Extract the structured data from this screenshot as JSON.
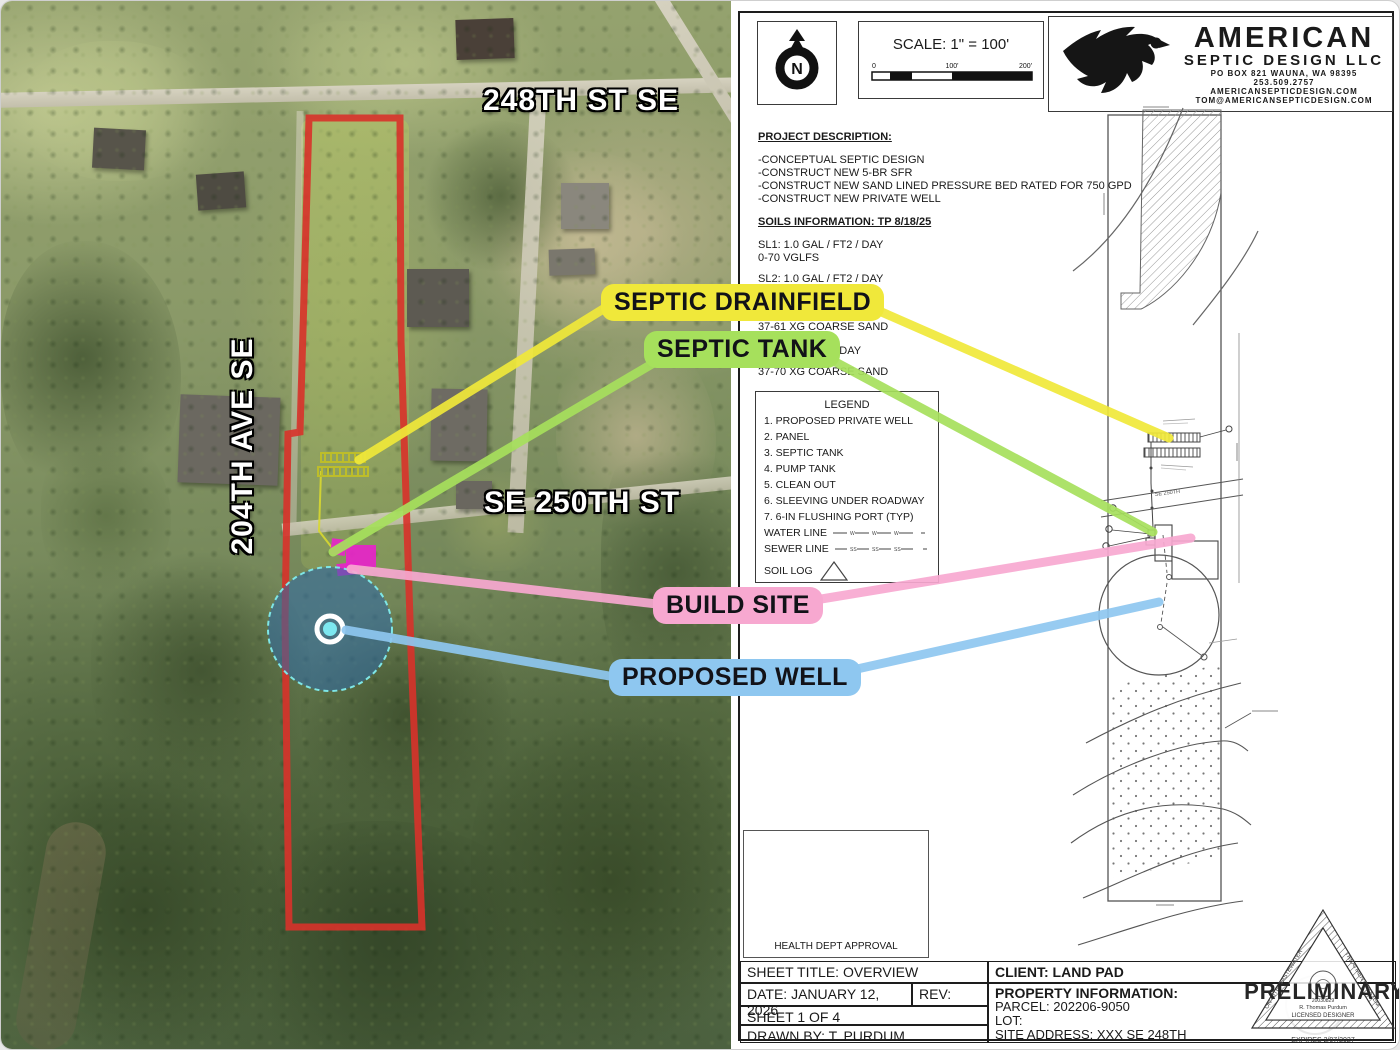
{
  "aerial": {
    "streets": {
      "st248": "248TH ST SE",
      "ave204": "204TH AVE SE",
      "st250": "SE 250TH ST"
    },
    "callouts": {
      "drainfield": {
        "label": "SEPTIC DRAINFIELD",
        "color": "#f0e83a"
      },
      "tank": {
        "label": "SEPTIC TANK",
        "color": "#a6e05c"
      },
      "build": {
        "label": "BUILD SITE",
        "color": "#f7a8d0"
      },
      "well": {
        "label": "PROPOSED WELL",
        "color": "#8ec7f0"
      }
    },
    "overlay_colors": {
      "parcel_outline": "#d8322a",
      "well_radius_fill": "#2e6aa8",
      "septic_marker": "#e724c9",
      "drainfield_marker": "#bdbd2a"
    }
  },
  "sheet": {
    "north_label": "N",
    "scale": {
      "title": "SCALE: 1\" = 100'",
      "tick0": "0",
      "tick100": "100'",
      "tick200": "200'"
    },
    "logo": {
      "line1": "AMERICAN",
      "line2": "SEPTIC DESIGN LLC",
      "line3": "PO BOX 821 WAUNA, WA 98395",
      "line4": "253.509.2757",
      "line5": "AMERICANSEPTICDESIGN.COM",
      "line6": "TOM@AMERICANSEPTICDESIGN.COM"
    },
    "project": {
      "heading": "PROJECT DESCRIPTION:",
      "items": [
        "-CONCEPTUAL SEPTIC DESIGN",
        "-CONSTRUCT NEW 5-BR SFR",
        "-CONSTRUCT NEW SAND LINED PRESSURE BED RATED FOR 750 GPD",
        "-CONSTRUCT NEW PRIVATE WELL"
      ]
    },
    "soils": {
      "heading": "SOILS INFORMATION: TP 8/18/25",
      "sl1": "SL1: 1.0 GAL / FT2 / DAY",
      "sl1b": "0-70 VGLFS",
      "sl2": "SL2: 1.0 GAL / FT2 / DAY",
      "frag1": "37-61 XG COARSE SAND",
      "frag2": "2 / DAY",
      "frag3": "37-70 XG COARSE SAND"
    },
    "legend": {
      "title": "LEGEND",
      "items": [
        "1. PROPOSED PRIVATE WELL",
        "2. PANEL",
        "3. SEPTIC TANK",
        "4. PUMP TANK",
        "5. CLEAN OUT",
        "6. SLEEVING UNDER ROADWAY",
        "7. 6-IN FLUSHING PORT (TYP)"
      ],
      "water": "WATER LINE",
      "sewer": "SEWER LINE",
      "soil": "SOIL LOG",
      "water_sym": "W",
      "sewer_sym": "SS"
    },
    "plan": {
      "road": "SE 250TH"
    },
    "health": "HEALTH DEPT APPROVAL",
    "titleblock": {
      "sheet_title": "SHEET TITLE: OVERVIEW",
      "client": "CLIENT: LAND PAD",
      "date": "DATE: JANUARY 12, 2026",
      "rev": "REV:",
      "property": "PROPERTY INFORMATION:",
      "parcel": "PARCEL: 202206-9050",
      "lot": "LOT:",
      "site": "SITE ADDRESS: XXX SE 248TH",
      "sheet_no": "SHEET 1 OF 4",
      "drawn": "DRAWN BY: T. PURDUM"
    },
    "stamp": {
      "word": "PRELIMINARY",
      "edge_left": "ON-SITE WASTEWATER",
      "edge_right": "TREATMENT SYSTEM",
      "num": "20030829",
      "name": "R. Thomas Purdum",
      "role": "LICENSED DESIGNER",
      "expires": "EXPIRES 2/07/2027"
    }
  }
}
